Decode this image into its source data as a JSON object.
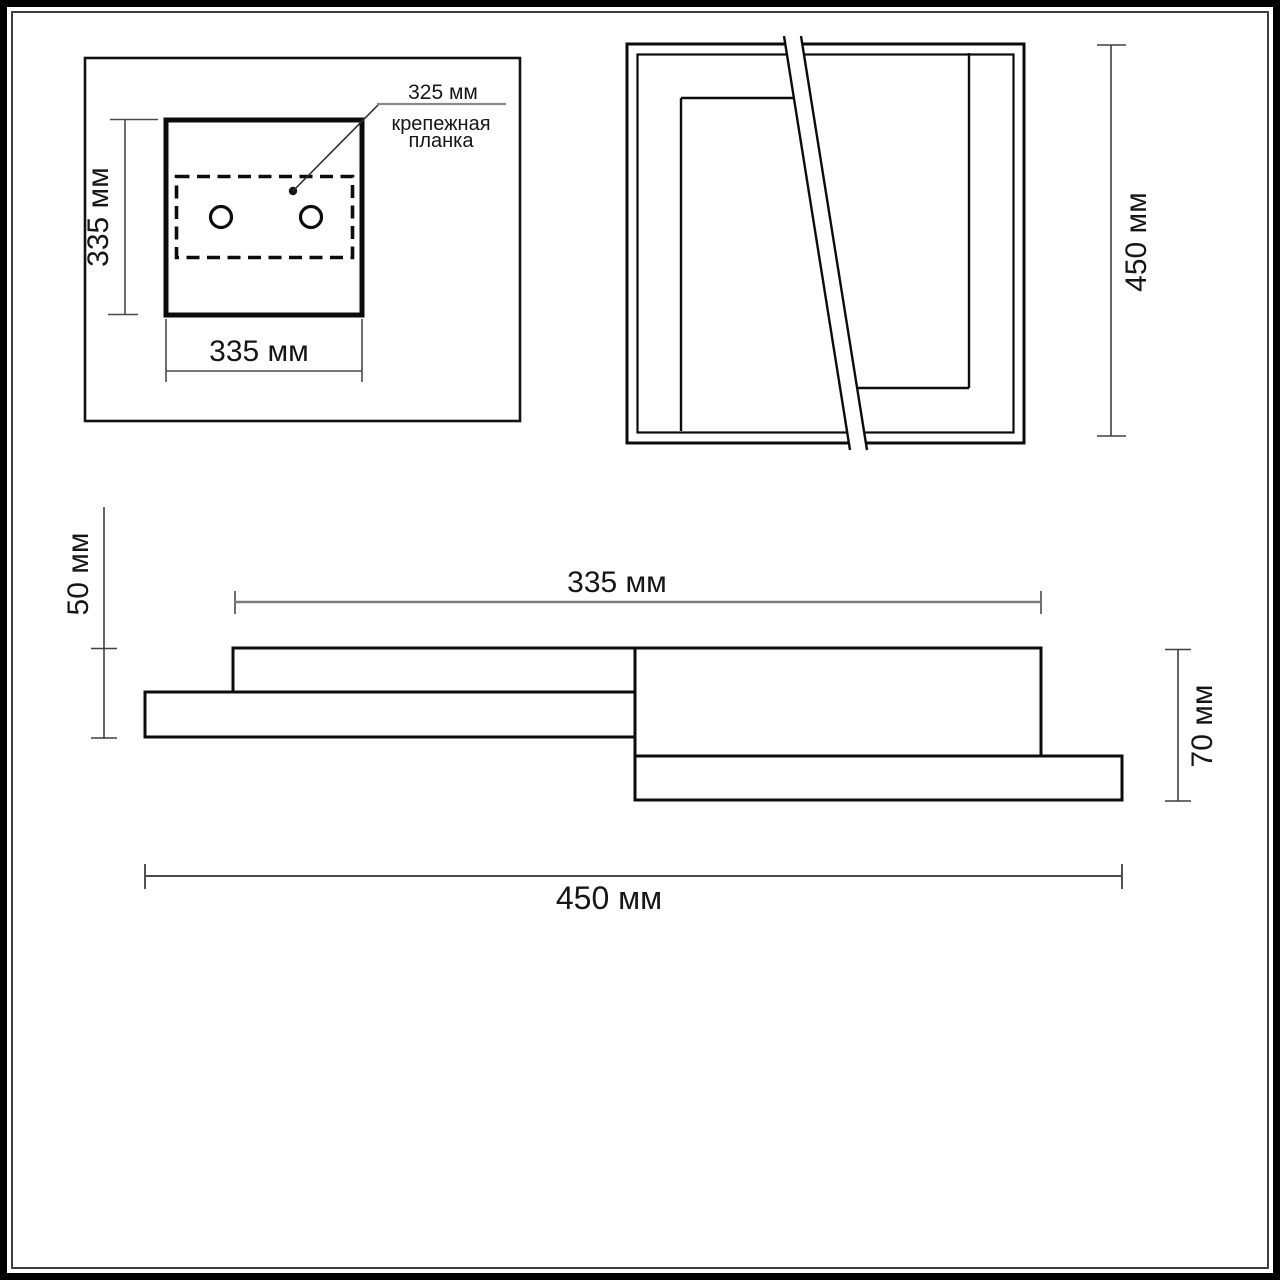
{
  "drawing": {
    "views": {
      "front": {
        "height_label": "335 мм",
        "width_label": "335 мм",
        "bracket_width_label": "325 мм",
        "bracket_name_line1": "крепежная",
        "bracket_name_line2": "планка"
      },
      "top": {
        "height_label": "450 мм"
      },
      "side": {
        "panel_width_label": "335 мм",
        "total_width_label": "450 мм",
        "left_height_label": "50 мм",
        "right_height_label": "70 мм"
      }
    },
    "colors": {
      "ink": "#161616",
      "dim_line": "#555555",
      "light_dim_line": "#8a8a8a"
    }
  }
}
